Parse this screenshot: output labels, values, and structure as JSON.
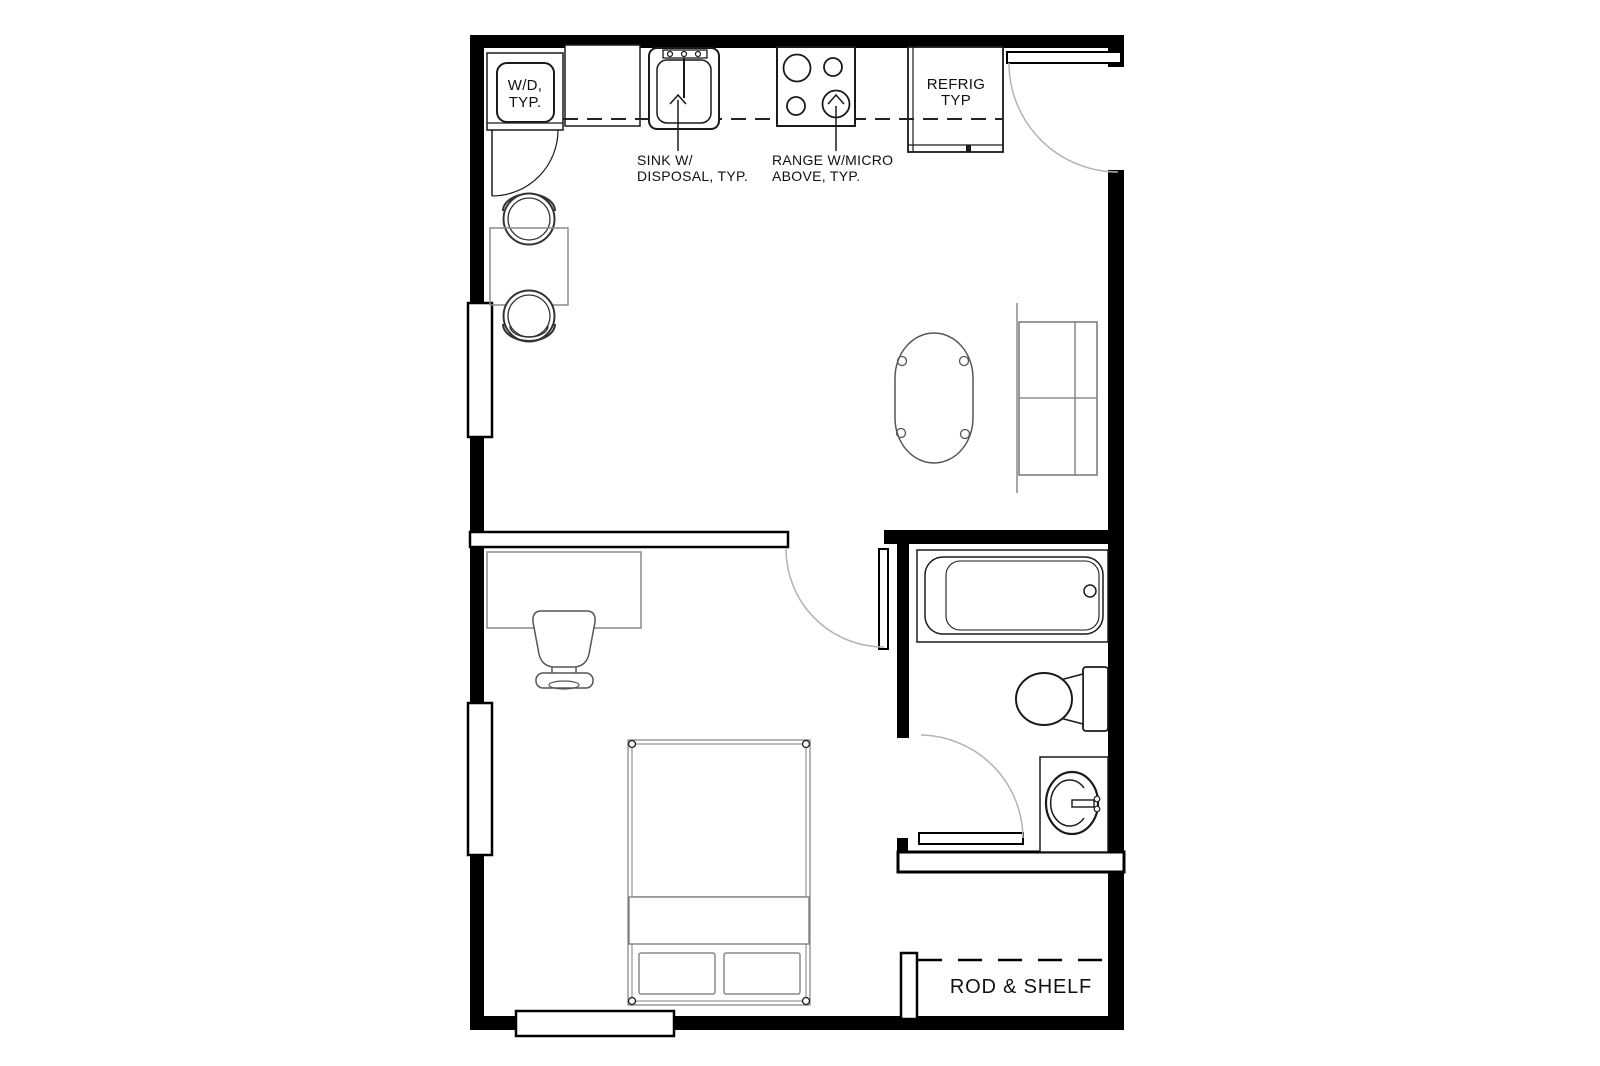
{
  "plan": {
    "title": "studio-apartment-floor-plan",
    "labels": {
      "washer_dryer": {
        "line1": "W/D,",
        "line2": "TYP."
      },
      "sink": {
        "line1": "SINK W/",
        "line2": "DISPOSAL, TYP."
      },
      "range": {
        "line1": "RANGE W/MICRO",
        "line2": "ABOVE, TYP."
      },
      "refrigerator": {
        "line1": "REFRIG",
        "line2": "TYP"
      },
      "closet": {
        "rod_shelf": "ROD & SHELF"
      }
    },
    "colors": {
      "wall": "#000000",
      "fixture_line": "#1a1a1a",
      "furniture_line": "#8a8a8a",
      "door_arc": "#b3b3b3",
      "background": "#ffffff"
    }
  }
}
